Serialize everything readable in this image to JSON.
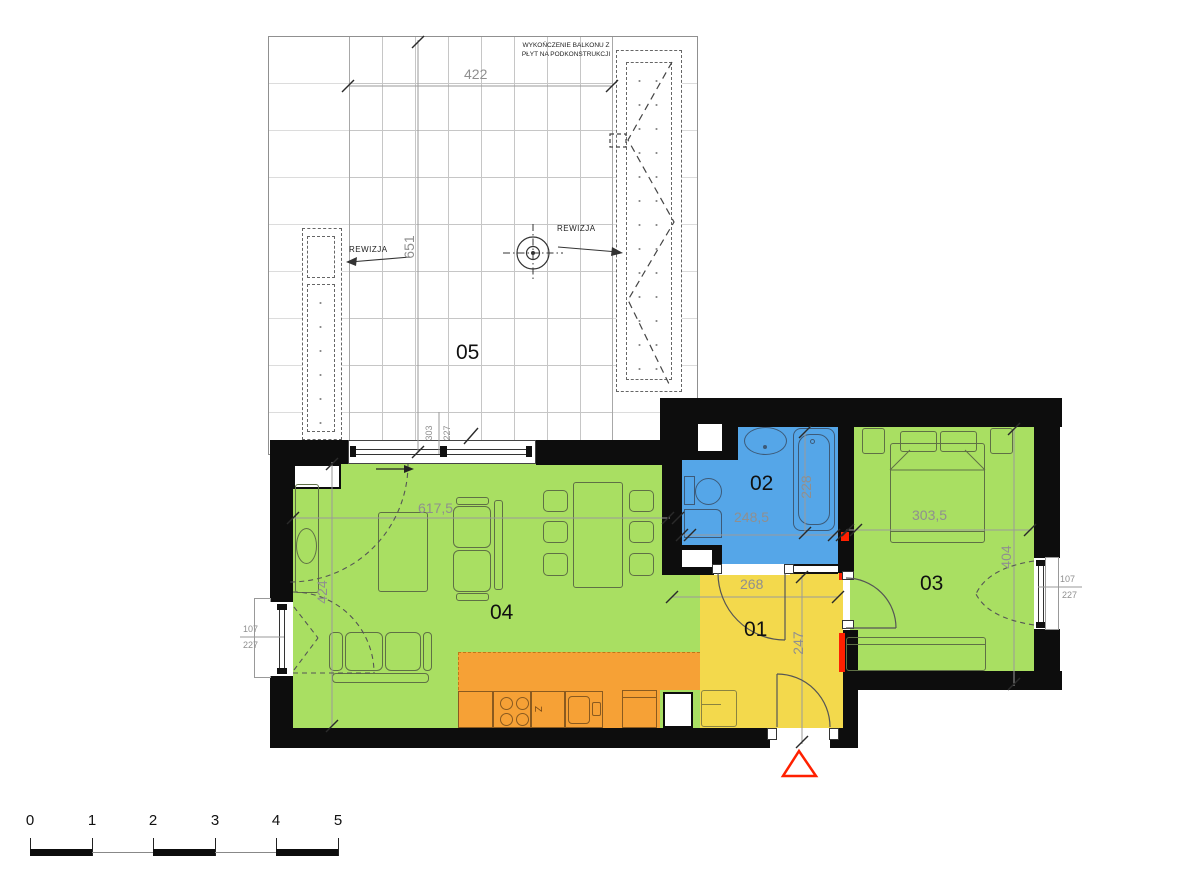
{
  "plan": {
    "title_note_line1": "WYKOŃCZENIE BALKONU Z",
    "title_note_line2": "PŁYT NA PODKONSTRUKCJI",
    "revision_left": "REWIZJA",
    "revision_right": "REWIZJA",
    "kitchen_mark": "Z",
    "rooms": {
      "hall": {
        "number": "01",
        "color": "#f3d94c"
      },
      "bathroom": {
        "number": "02",
        "color": "#55a6e8"
      },
      "bedroom": {
        "number": "03",
        "color": "#a9df62"
      },
      "living": {
        "number": "04",
        "color": "#a9df62"
      },
      "balcony": {
        "number": "05",
        "color": "#ffffff"
      }
    },
    "colors": {
      "wall": "#0d0d0d",
      "kitchen_zone": "#f6a136",
      "accent_red": "#ff2000"
    },
    "dimensions": {
      "balcony_width": "422",
      "balcony_depth": "651",
      "balcony_door_w": "303",
      "balcony_door_h": "227",
      "living_width": "617,5",
      "living_depth": "424",
      "living_window_w": "107",
      "living_window_h": "227",
      "bathroom_width": "248,5",
      "bathroom_depth": "228",
      "hall_width": "268",
      "hall_depth": "247",
      "bedroom_width": "303,5",
      "bedroom_depth": "404",
      "bedroom_window_w": "107",
      "bedroom_window_h": "227"
    },
    "scale_bar": {
      "ticks": [
        "0",
        "1",
        "2",
        "3",
        "4",
        "5"
      ]
    }
  }
}
